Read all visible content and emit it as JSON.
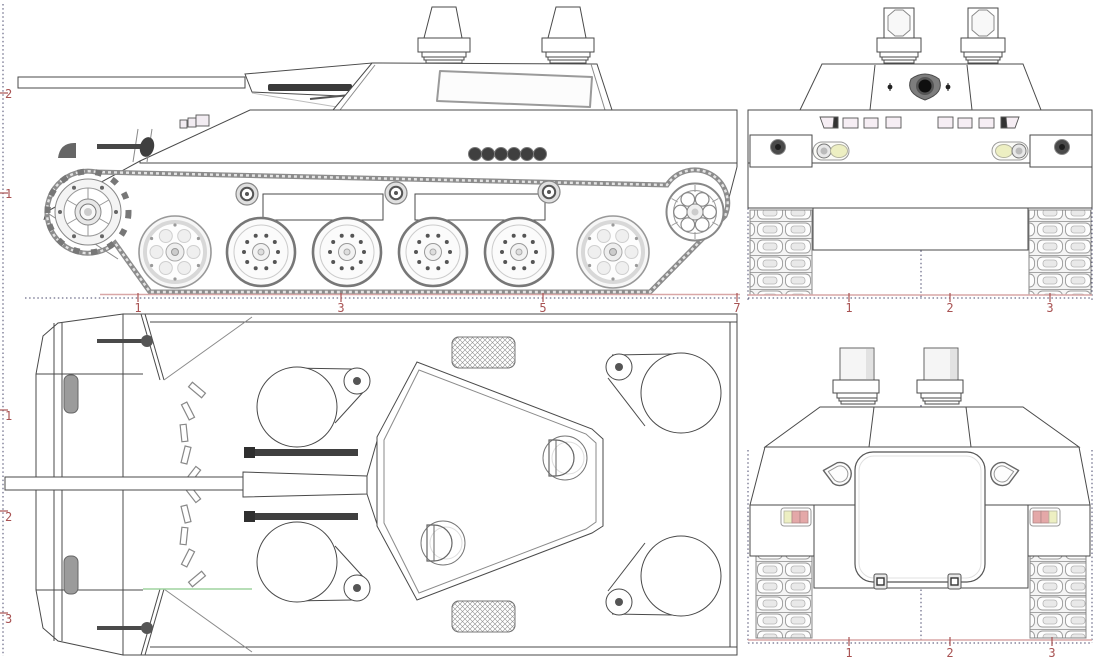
{
  "drawing": {
    "title": "Four-view technical blueprint of a tracked armored vehicle",
    "views": {
      "side": {
        "name": "side elevation"
      },
      "front": {
        "name": "front elevation"
      },
      "top": {
        "name": "top plan"
      },
      "rear": {
        "name": "rear elevation"
      }
    }
  },
  "rulers": {
    "side_left": {
      "labels": [
        "2",
        "1"
      ]
    },
    "side_bottom": {
      "labels": [
        "1",
        "3",
        "5",
        "7"
      ]
    },
    "top_left": {
      "labels": [
        "1",
        "2",
        "3"
      ]
    },
    "front_bottom": {
      "labels": [
        "1",
        "2",
        "3"
      ]
    },
    "rear_bottom": {
      "labels": [
        "1",
        "2",
        "3"
      ]
    }
  },
  "colors": {
    "line": "#4a4a4a",
    "ruler_red": "#a85252",
    "ruler_dotted": "#47476b",
    "ground_pink": "#d9a7a7",
    "reference_green": "#9fd49f",
    "lamp_yellow": "#edefc2",
    "lamp_pink": "#e4a8a8",
    "metal_gray": "#9b9b9b",
    "dark_detail": "#3f3f3f"
  }
}
